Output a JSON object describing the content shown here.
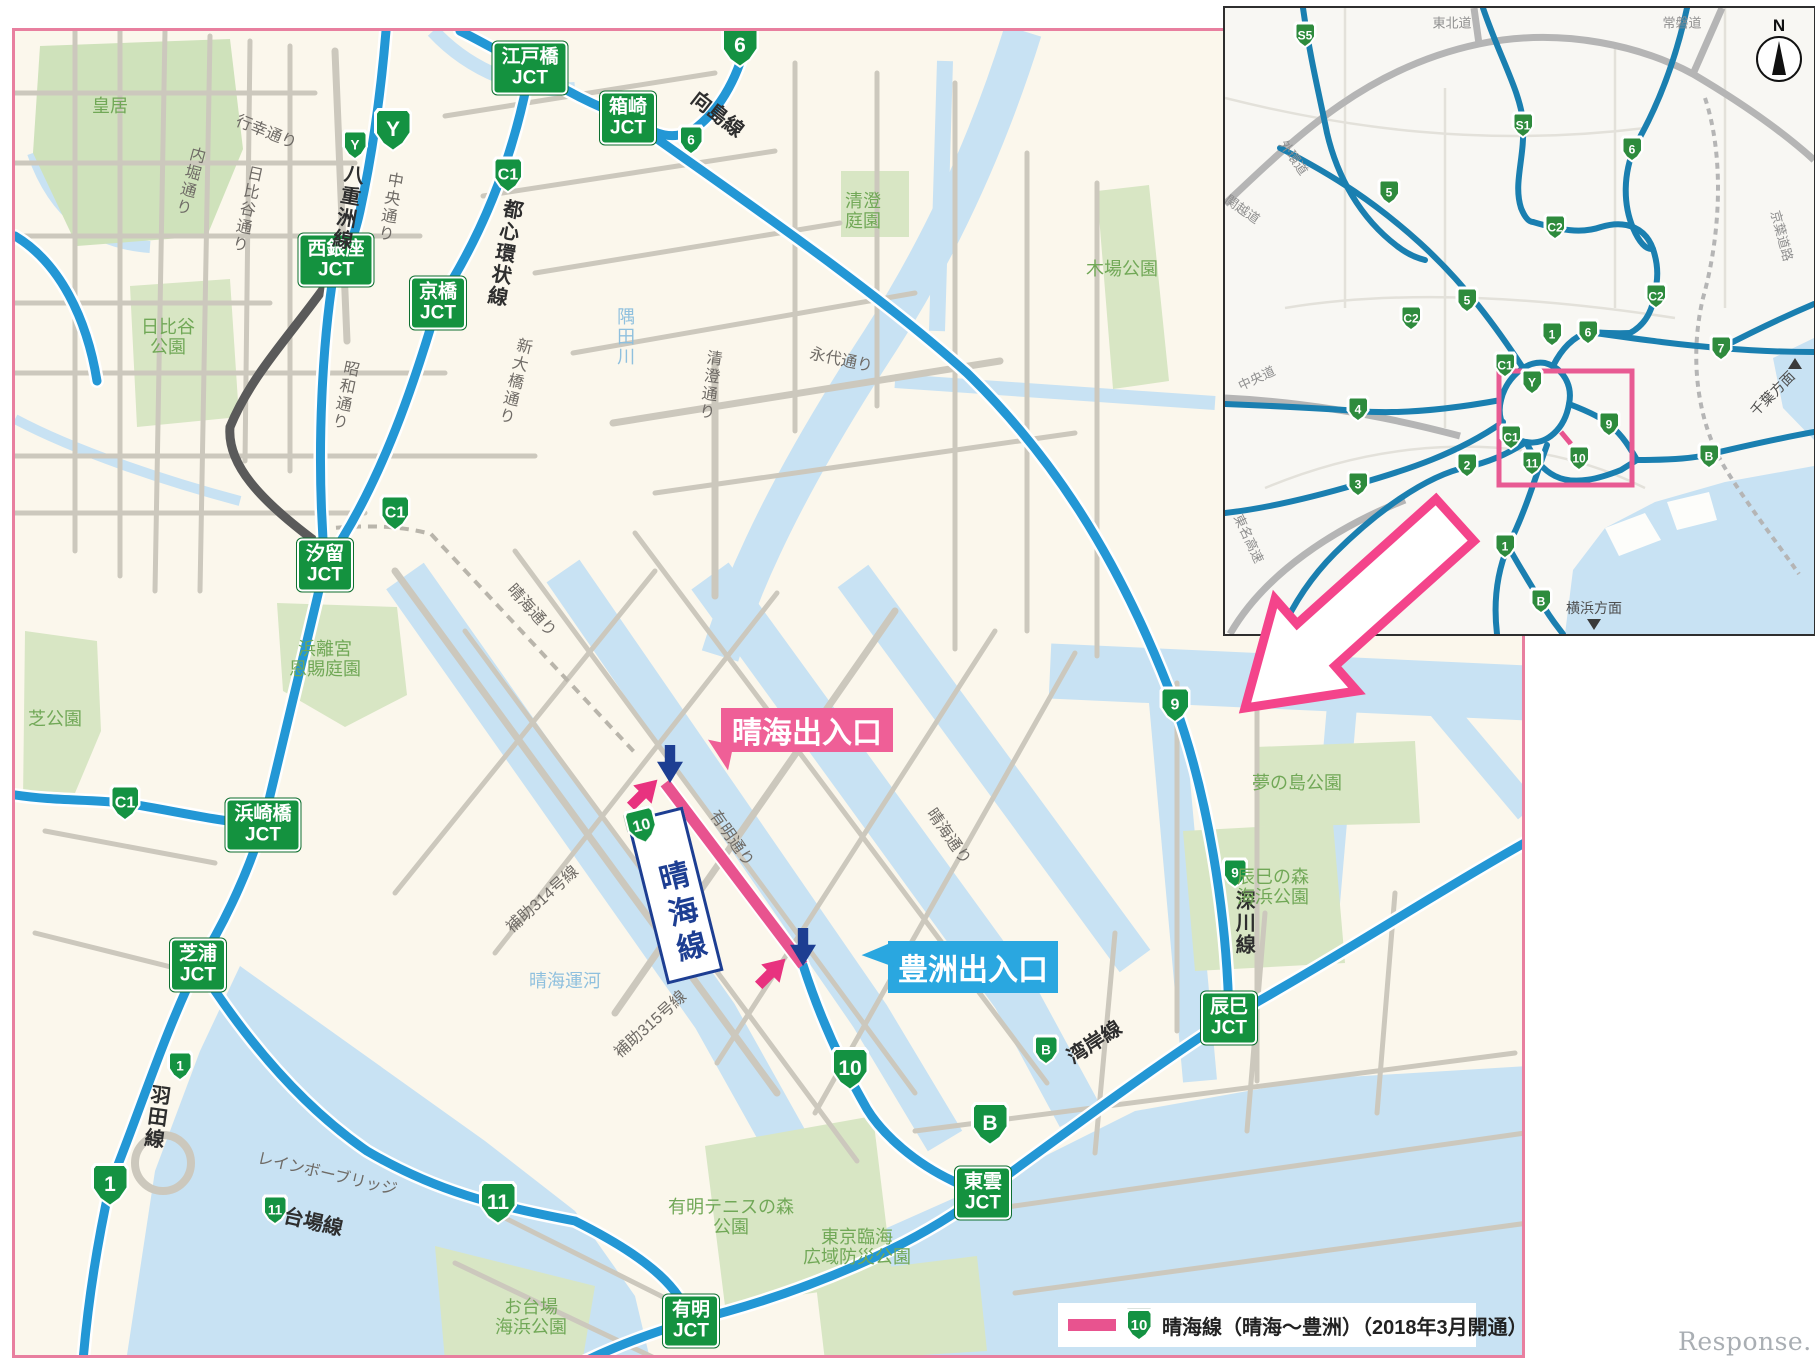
{
  "watermark": "Response.",
  "legend": {
    "route_shield": "10",
    "text": "晴海線（晴海～豊洲）（2018年3月開通）",
    "swatch_color": "#e8538f"
  },
  "colors": {
    "highway_blue": "#2397d5",
    "new_section_pink": "#e8538f",
    "badge_green": "#149242",
    "water": "#c8e2f3",
    "park": "#d8e6c4",
    "map_border_pink": "#e87f9f",
    "callout_pink": "#ef5f97",
    "callout_blue": "#2aa7e0",
    "arrow_navy": "#1d3e92",
    "arrow_pink": "#e8327f"
  },
  "main_map": {
    "junction_boxes": [
      {
        "name": "江戸橋",
        "sub": "JCT",
        "x": 515,
        "y": 37
      },
      {
        "name": "箱崎",
        "sub": "JCT",
        "x": 613,
        "y": 87
      },
      {
        "name": "西銀座",
        "sub": "JCT",
        "x": 321,
        "y": 229
      },
      {
        "name": "京橋",
        "sub": "JCT",
        "x": 423,
        "y": 272
      },
      {
        "name": "汐留",
        "sub": "JCT",
        "x": 310,
        "y": 534
      },
      {
        "name": "浜崎橋",
        "sub": "JCT",
        "x": 248,
        "y": 794
      },
      {
        "name": "芝浦",
        "sub": "JCT",
        "x": 183,
        "y": 934
      },
      {
        "name": "有明",
        "sub": "JCT",
        "x": 676,
        "y": 1290
      },
      {
        "name": "東雲",
        "sub": "JCT",
        "x": 968,
        "y": 1162
      },
      {
        "name": "辰巳",
        "sub": "JCT",
        "x": 1214,
        "y": 987
      }
    ],
    "route_shields": [
      {
        "num": "Y",
        "x": 378,
        "y": 99,
        "size": "lg"
      },
      {
        "num": "6",
        "x": 725,
        "y": 15,
        "size": "lg"
      },
      {
        "num": "Y",
        "x": 340,
        "y": 114,
        "size": "sm"
      },
      {
        "num": "6",
        "x": 676,
        "y": 109,
        "size": "sm"
      },
      {
        "num": "C1",
        "x": 493,
        "y": 144,
        "size": "md"
      },
      {
        "num": "C1",
        "x": 380,
        "y": 482,
        "size": "md"
      },
      {
        "num": "C1",
        "x": 110,
        "y": 772,
        "size": "md"
      },
      {
        "num": "9",
        "x": 1160,
        "y": 674,
        "size": "md"
      },
      {
        "num": "9",
        "x": 1220,
        "y": 842,
        "size": "sm"
      },
      {
        "num": "1",
        "x": 165,
        "y": 1035,
        "size": "sm"
      },
      {
        "num": "1",
        "x": 95,
        "y": 1154,
        "size": "lg"
      },
      {
        "num": "11",
        "x": 260,
        "y": 1179,
        "size": "sm"
      },
      {
        "num": "11",
        "x": 483,
        "y": 1172,
        "size": "lg"
      },
      {
        "num": "10",
        "x": 835,
        "y": 1038,
        "size": "lg"
      },
      {
        "num": "B",
        "x": 1031,
        "y": 1019,
        "size": "sm"
      },
      {
        "num": "B",
        "x": 975,
        "y": 1093,
        "size": "lg"
      }
    ],
    "line_labels": [
      {
        "text": "八重洲線",
        "x": 331,
        "y": 176,
        "rot": 10,
        "vertical": true
      },
      {
        "text": "向島線",
        "x": 702,
        "y": 84,
        "rot": 38,
        "vertical": false
      },
      {
        "text": "都心環状線",
        "x": 488,
        "y": 222,
        "rot": 10,
        "vertical": true
      },
      {
        "text": "深川線",
        "x": 1228,
        "y": 892,
        "rot": 0,
        "vertical": true
      },
      {
        "text": "羽田線",
        "x": 140,
        "y": 1086,
        "rot": 8,
        "vertical": true
      },
      {
        "text": "台場線",
        "x": 298,
        "y": 1192,
        "rot": 13,
        "vertical": false
      },
      {
        "text": "湾岸線",
        "x": 1080,
        "y": 1012,
        "rot": -33,
        "vertical": false
      }
    ],
    "street_labels": [
      {
        "text": "行幸通り",
        "x": 251,
        "y": 102,
        "rot": 22,
        "vertical": false
      },
      {
        "text": "内堀通り",
        "x": 173,
        "y": 150,
        "rot": 15,
        "vertical": true
      },
      {
        "text": "日比谷通り",
        "x": 230,
        "y": 178,
        "rot": 12,
        "vertical": true
      },
      {
        "text": "中央通り",
        "x": 373,
        "y": 176,
        "rot": 10,
        "vertical": true
      },
      {
        "text": "昭和通り",
        "x": 328,
        "y": 364,
        "rot": 12,
        "vertical": true
      },
      {
        "text": "新大橋通り",
        "x": 498,
        "y": 350,
        "rot": 14,
        "vertical": true
      },
      {
        "text": "清澄通り",
        "x": 693,
        "y": 354,
        "rot": 8,
        "vertical": true
      },
      {
        "text": "永代通り",
        "x": 826,
        "y": 330,
        "rot": 12,
        "vertical": false
      },
      {
        "text": "晴海通り",
        "x": 516,
        "y": 580,
        "rot": 48,
        "vertical": false
      },
      {
        "text": "晴海通り",
        "x": 933,
        "y": 806,
        "rot": 55,
        "vertical": false
      },
      {
        "text": "有明通り",
        "x": 716,
        "y": 808,
        "rot": 55,
        "vertical": false
      },
      {
        "text": "補助314号線",
        "x": 528,
        "y": 869,
        "rot": -42,
        "vertical": false
      },
      {
        "text": "補助315号線",
        "x": 636,
        "y": 994,
        "rot": -42,
        "vertical": false
      },
      {
        "text": "レインボーブリッジ",
        "x": 312,
        "y": 1144,
        "rot": 13,
        "vertical": false
      }
    ],
    "park_labels": [
      {
        "text": "皇居",
        "x": 95,
        "y": 75
      },
      {
        "text": "日比谷\n公園",
        "x": 153,
        "y": 306
      },
      {
        "text": "清澄\n庭園",
        "x": 848,
        "y": 180
      },
      {
        "text": "木場公園",
        "x": 1107,
        "y": 238
      },
      {
        "text": "浜離宮\n恩賜庭園",
        "x": 310,
        "y": 628
      },
      {
        "text": "芝公園",
        "x": 40,
        "y": 688
      },
      {
        "text": "夢の島公園",
        "x": 1282,
        "y": 752
      },
      {
        "text": "辰巳の森\n海浜公園",
        "x": 1258,
        "y": 856
      },
      {
        "text": "有明テニスの森\n公園",
        "x": 716,
        "y": 1186
      },
      {
        "text": "東京臨海\n広域防災公園",
        "x": 842,
        "y": 1216
      },
      {
        "text": "お台場\n海浜公園",
        "x": 516,
        "y": 1286
      }
    ],
    "water_labels": [
      {
        "text": "隅田川",
        "x": 610,
        "y": 306,
        "vertical": true
      },
      {
        "text": "晴海運河",
        "x": 550,
        "y": 950,
        "vertical": false
      }
    ],
    "callouts": [
      {
        "id": "harumi-entrance",
        "text": "晴海出入口",
        "x": 706,
        "y": 677,
        "w": 172,
        "h": 44,
        "color": "#ef5f97",
        "tail": "bl"
      },
      {
        "id": "toyosu-entrance",
        "text": "豊洲出入口",
        "x": 873,
        "y": 910,
        "w": 170,
        "h": 52,
        "color": "#2aa7e0",
        "tail": "l"
      }
    ],
    "route_label_box": {
      "shield": "10",
      "text": "晴海線",
      "x": 660,
      "y": 854,
      "rot": -14
    },
    "entry_arrows": [
      {
        "dir": "down",
        "color": "#1d3e92",
        "x": 655,
        "y": 733
      },
      {
        "dir": "nw",
        "color": "#e8327f",
        "x": 629,
        "y": 762
      },
      {
        "dir": "down",
        "color": "#1d3e92",
        "x": 788,
        "y": 916
      },
      {
        "dir": "nw",
        "color": "#e8327f",
        "x": 757,
        "y": 941
      }
    ]
  },
  "inset_map": {
    "compass": "N",
    "route_shields": [
      {
        "num": "S5",
        "x": 80,
        "y": 27
      },
      {
        "num": "S1",
        "x": 298,
        "y": 117
      },
      {
        "num": "6",
        "x": 407,
        "y": 141
      },
      {
        "num": "5",
        "x": 164,
        "y": 184
      },
      {
        "num": "C2",
        "x": 330,
        "y": 219
      },
      {
        "num": "C2",
        "x": 431,
        "y": 288
      },
      {
        "num": "5",
        "x": 242,
        "y": 292
      },
      {
        "num": "C2",
        "x": 186,
        "y": 310
      },
      {
        "num": "1",
        "x": 327,
        "y": 326
      },
      {
        "num": "6",
        "x": 363,
        "y": 324
      },
      {
        "num": "7",
        "x": 496,
        "y": 340
      },
      {
        "num": "C1",
        "x": 280,
        "y": 357
      },
      {
        "num": "Y",
        "x": 307,
        "y": 374
      },
      {
        "num": "9",
        "x": 384,
        "y": 416
      },
      {
        "num": "C1",
        "x": 286,
        "y": 429
      },
      {
        "num": "10",
        "x": 354,
        "y": 450
      },
      {
        "num": "11",
        "x": 307,
        "y": 455
      },
      {
        "num": "2",
        "x": 242,
        "y": 457
      },
      {
        "num": "4",
        "x": 133,
        "y": 401
      },
      {
        "num": "3",
        "x": 133,
        "y": 476
      },
      {
        "num": "B",
        "x": 484,
        "y": 448
      },
      {
        "num": "1",
        "x": 280,
        "y": 538
      },
      {
        "num": "B",
        "x": 316,
        "y": 593
      }
    ],
    "road_labels": [
      {
        "text": "東北道",
        "x": 227,
        "y": 16,
        "rot": 0
      },
      {
        "text": "常磐道",
        "x": 457,
        "y": 16,
        "rot": 0
      },
      {
        "text": "外環道",
        "x": 68,
        "y": 150,
        "rot": 55
      },
      {
        "text": "関越道",
        "x": 17,
        "y": 202,
        "rot": 35
      },
      {
        "text": "中央道",
        "x": 32,
        "y": 371,
        "rot": -25
      },
      {
        "text": "東名高速",
        "x": 23,
        "y": 531,
        "rot": 65
      },
      {
        "text": "京葉道路",
        "x": 556,
        "y": 228,
        "rot": 75
      }
    ],
    "direction_labels": [
      {
        "text": "千葉方面",
        "x": 548,
        "y": 386,
        "rot": -45,
        "marker": "up",
        "mx": 570,
        "my": 356
      },
      {
        "text": "横浜方面",
        "x": 369,
        "y": 601,
        "rot": 0,
        "marker": "down",
        "mx": 369,
        "my": 617
      }
    ]
  }
}
